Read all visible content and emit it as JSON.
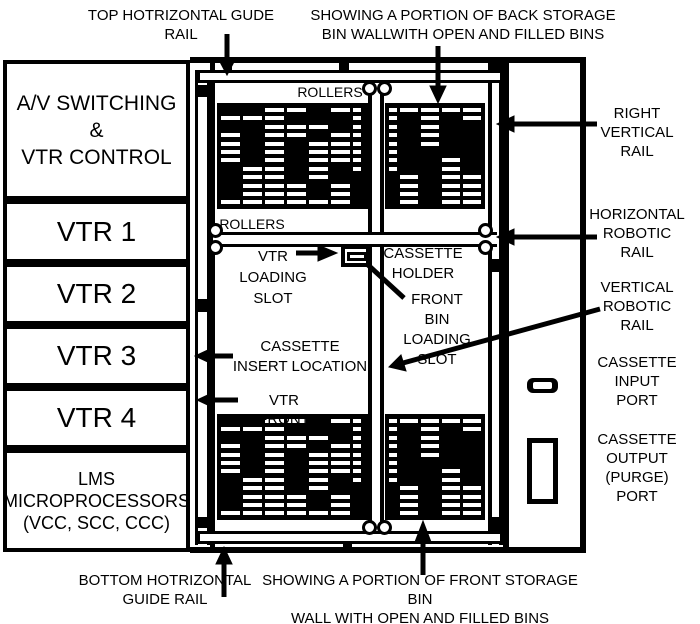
{
  "left_panel": {
    "av_box": "A/V SWITCHING\n&\nVTR CONTROL",
    "vtr1": "VTR 1",
    "vtr2": "VTR 2",
    "vtr3": "VTR 3",
    "vtr4": "VTR 4",
    "lms_box": "LMS\nMICROPROCESSORS\n(VCC, SCC, CCC)"
  },
  "annotations": {
    "top_rail": "TOP HOTRIZONTAL GUDE\nRAIL",
    "back_wall": "SHOWING A PORTION OF BACK STORAGE\nBIN WALLWITH OPEN AND FILLED BINS",
    "rollers_top": "ROLLERS",
    "rollers_mid": "ROLLERS",
    "vtr_loading_slot": "VTR\nLOADING\nSLOT",
    "cassette_holder": "CASSETTE\nHOLDER",
    "front_bin_loading_slot": "FRONT BIN\nLOADING\nSLOT",
    "cassette_insert_location": "CASSETTE\nINSERT LOCATION",
    "vtr_front": "VTR FRONT",
    "right_vertical_rail": "RIGHT\nVERTICAL\nRAIL",
    "horizontal_robotic_rail": "HORIZONTAL\nROBOTIC\nRAIL",
    "vertical_robotic_rail": "VERTICAL\nROBOTIC\nRAIL",
    "cassette_input_port": "CASSETTE\nINPUT\nPORT",
    "cassette_output_port": "CASSETTE\nOUTPUT\n(PURGE)\nPORT",
    "bottom_rail": "BOTTOM  HOTRIZONTAL\nGUIDE RAIL",
    "front_wall": "SHOWING A PORTION OF FRONT STORAGE BIN\nWALL WITH OPEN AND FILLED BINS"
  },
  "colors": {
    "ink": "#000000",
    "paper": "#ffffff"
  },
  "bins": {
    "top_left": {
      "cols": [
        {
          "w": 19,
          "p": "010111100001"
        },
        {
          "w": 19,
          "p": "010000011111"
        },
        {
          "w": 19,
          "p": "111111111111"
        },
        {
          "w": 19,
          "p": "101100000111"
        },
        {
          "w": 19,
          "p": "001011111001"
        },
        {
          "w": 19,
          "p": "100111100111"
        },
        {
          "w": 8,
          "p": "111111110000"
        }
      ]
    },
    "top_right": {
      "cols": [
        {
          "w": 8,
          "p": "111111110000"
        },
        {
          "w": 18,
          "p": "100000001111"
        },
        {
          "w": 18,
          "p": "111110000000"
        },
        {
          "w": 18,
          "p": "100000111111"
        },
        {
          "w": 18,
          "p": "110000001111"
        }
      ]
    },
    "bottom_left": {
      "cols": [
        {
          "w": 19,
          "p": "010111100001"
        },
        {
          "w": 19,
          "p": "010000011111"
        },
        {
          "w": 19,
          "p": "111111111111"
        },
        {
          "w": 19,
          "p": "101100000111"
        },
        {
          "w": 19,
          "p": "001011111001"
        },
        {
          "w": 19,
          "p": "100111100111"
        },
        {
          "w": 8,
          "p": "111111110000"
        }
      ]
    },
    "bottom_right": {
      "cols": [
        {
          "w": 8,
          "p": "111111110000"
        },
        {
          "w": 18,
          "p": "100000001111"
        },
        {
          "w": 18,
          "p": "111110000000"
        },
        {
          "w": 18,
          "p": "100000111111"
        },
        {
          "w": 18,
          "p": "110000001111"
        }
      ]
    }
  }
}
